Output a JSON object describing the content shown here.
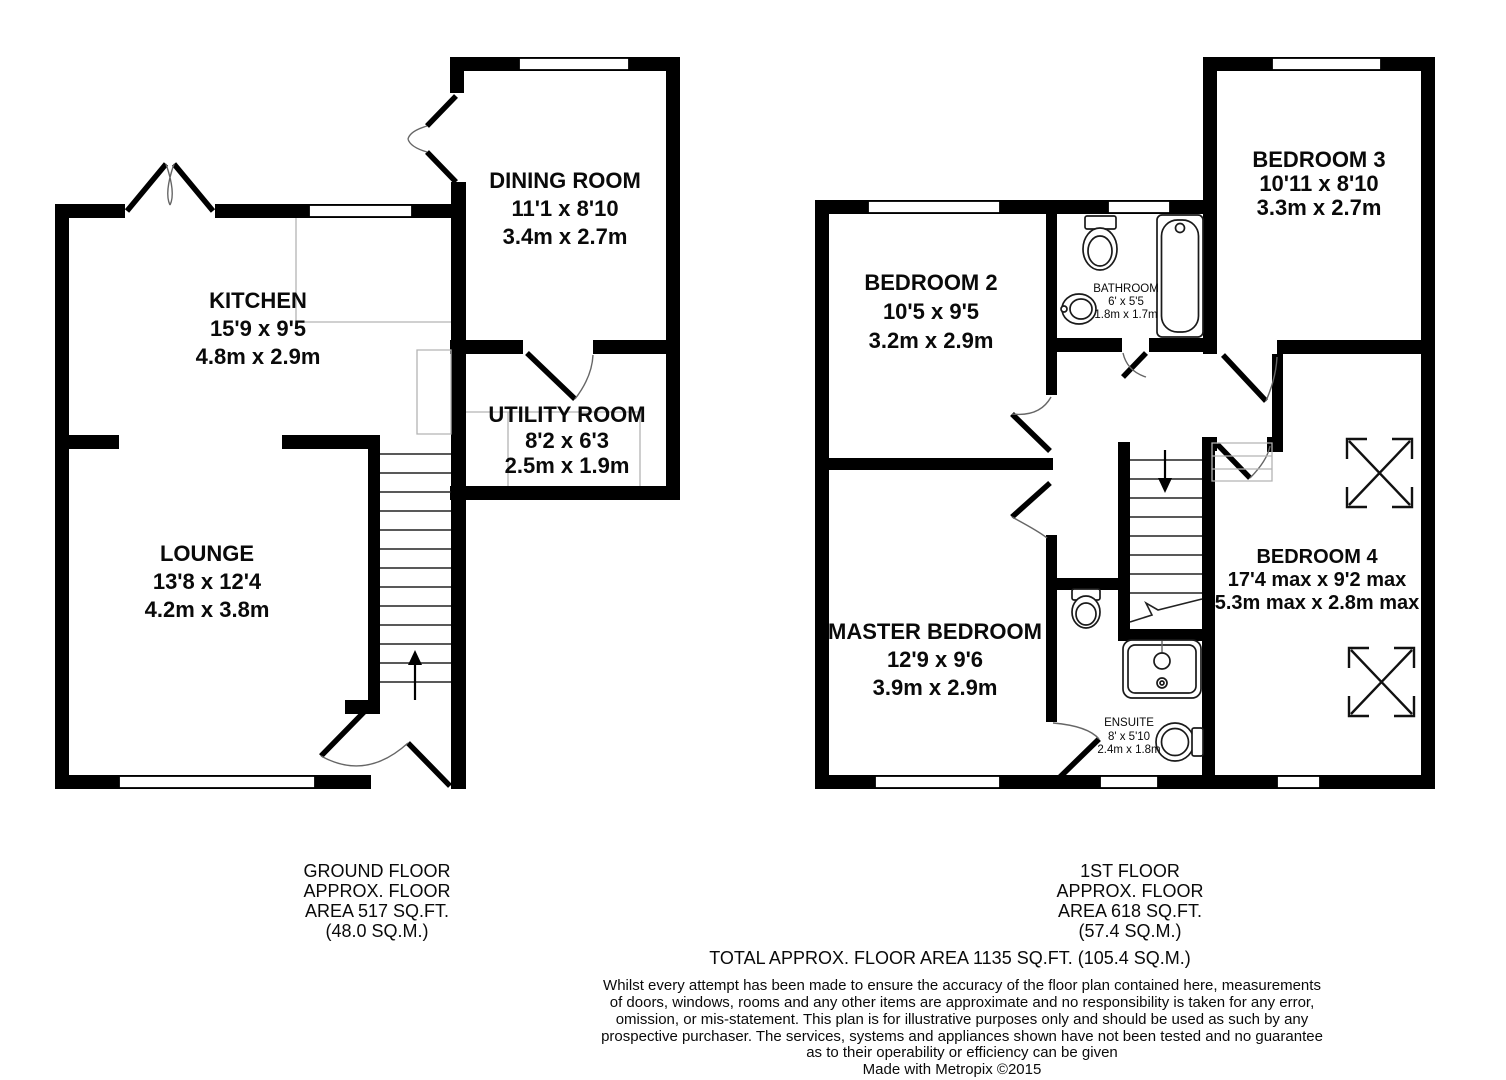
{
  "ground": {
    "rooms": {
      "dining": {
        "name": "DINING ROOM",
        "imperial": "11'1 x 8'10",
        "metric": "3.4m x 2.7m"
      },
      "kitchen": {
        "name": "KITCHEN",
        "imperial": "15'9 x 9'5",
        "metric": "4.8m x 2.9m"
      },
      "utility": {
        "name": "UTILITY ROOM",
        "imperial": "8'2 x 6'3",
        "metric": "2.5m x 1.9m"
      },
      "lounge": {
        "name": "LOUNGE",
        "imperial": "13'8 x 12'4",
        "metric": "4.2m x 3.8m"
      }
    },
    "footer": [
      "GROUND FLOOR",
      "APPROX. FLOOR",
      "AREA 517 SQ.FT.",
      "(48.0 SQ.M.)"
    ]
  },
  "first": {
    "rooms": {
      "bedroom2": {
        "name": "BEDROOM 2",
        "imperial": "10'5 x 9'5",
        "metric": "3.2m x 2.9m"
      },
      "bathroom": {
        "name": "BATHROOM",
        "imperial": "6' x 5'5",
        "metric": "1.8m x 1.7m"
      },
      "bedroom3": {
        "name": "BEDROOM 3",
        "imperial": "10'11 x 8'10",
        "metric": "3.3m x 2.7m"
      },
      "master": {
        "name": "MASTER BEDROOM",
        "imperial": "12'9 x 9'6",
        "metric": "3.9m x 2.9m"
      },
      "bedroom4": {
        "name": "BEDROOM 4",
        "imperial": "17'4 max x 9'2 max",
        "metric": "5.3m max x 2.8m max"
      },
      "ensuite": {
        "name": "ENSUITE",
        "imperial": "8' x 5'10",
        "metric": "2.4m x 1.8m"
      }
    },
    "footer": [
      "1ST FLOOR",
      "APPROX. FLOOR",
      "AREA 618 SQ.FT.",
      "(57.4 SQ.M.)"
    ]
  },
  "summary": {
    "total": "TOTAL APPROX. FLOOR AREA 1135 SQ.FT. (105.4 SQ.M.)",
    "disclaimer": [
      "Whilst every attempt has been made to ensure the accuracy of the floor plan contained here, measurements",
      "of doors, windows, rooms and any other items are approximate and no responsibility is taken for any error,",
      "omission, or mis-statement. This plan is for illustrative purposes only and should be used as such by any",
      "prospective purchaser. The services, systems and appliances shown have not been tested and no guarantee",
      "as to their operability or efficiency can be given"
    ],
    "credit": "Made with Metropix ©2015"
  },
  "colors": {
    "wall": "#000000",
    "window_fill": "#ffffff",
    "annotation_gray": "#b3b3b3"
  }
}
